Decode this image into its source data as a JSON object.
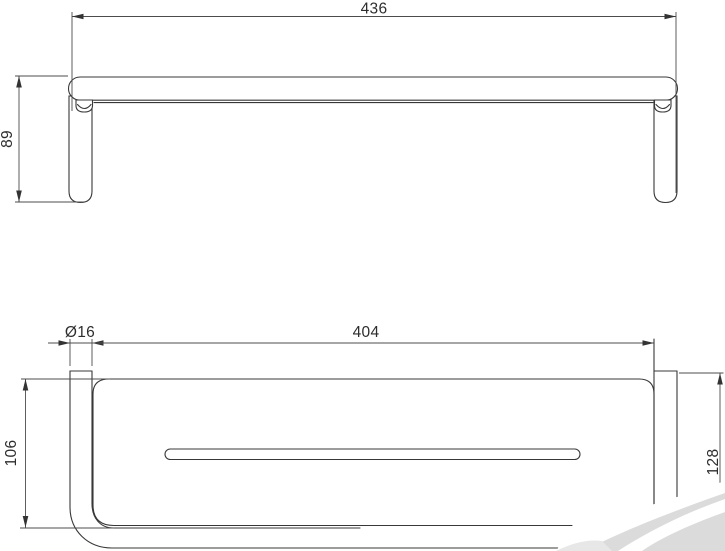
{
  "page": {
    "background": "#ffffff"
  },
  "drawing": {
    "type": "technical-dimension-drawing",
    "front_view": {
      "overall_width": "436",
      "overall_height": "89"
    },
    "plan_view": {
      "tube_diameter": "Ø16",
      "inner_width": "404",
      "shelf_depth": "106",
      "overall_depth": "128"
    }
  },
  "colors": {
    "line": "#383838",
    "dimension_line": "#4c4c4c",
    "text": "#2d2d2d",
    "watermark_gray": "#dbdbdb"
  }
}
